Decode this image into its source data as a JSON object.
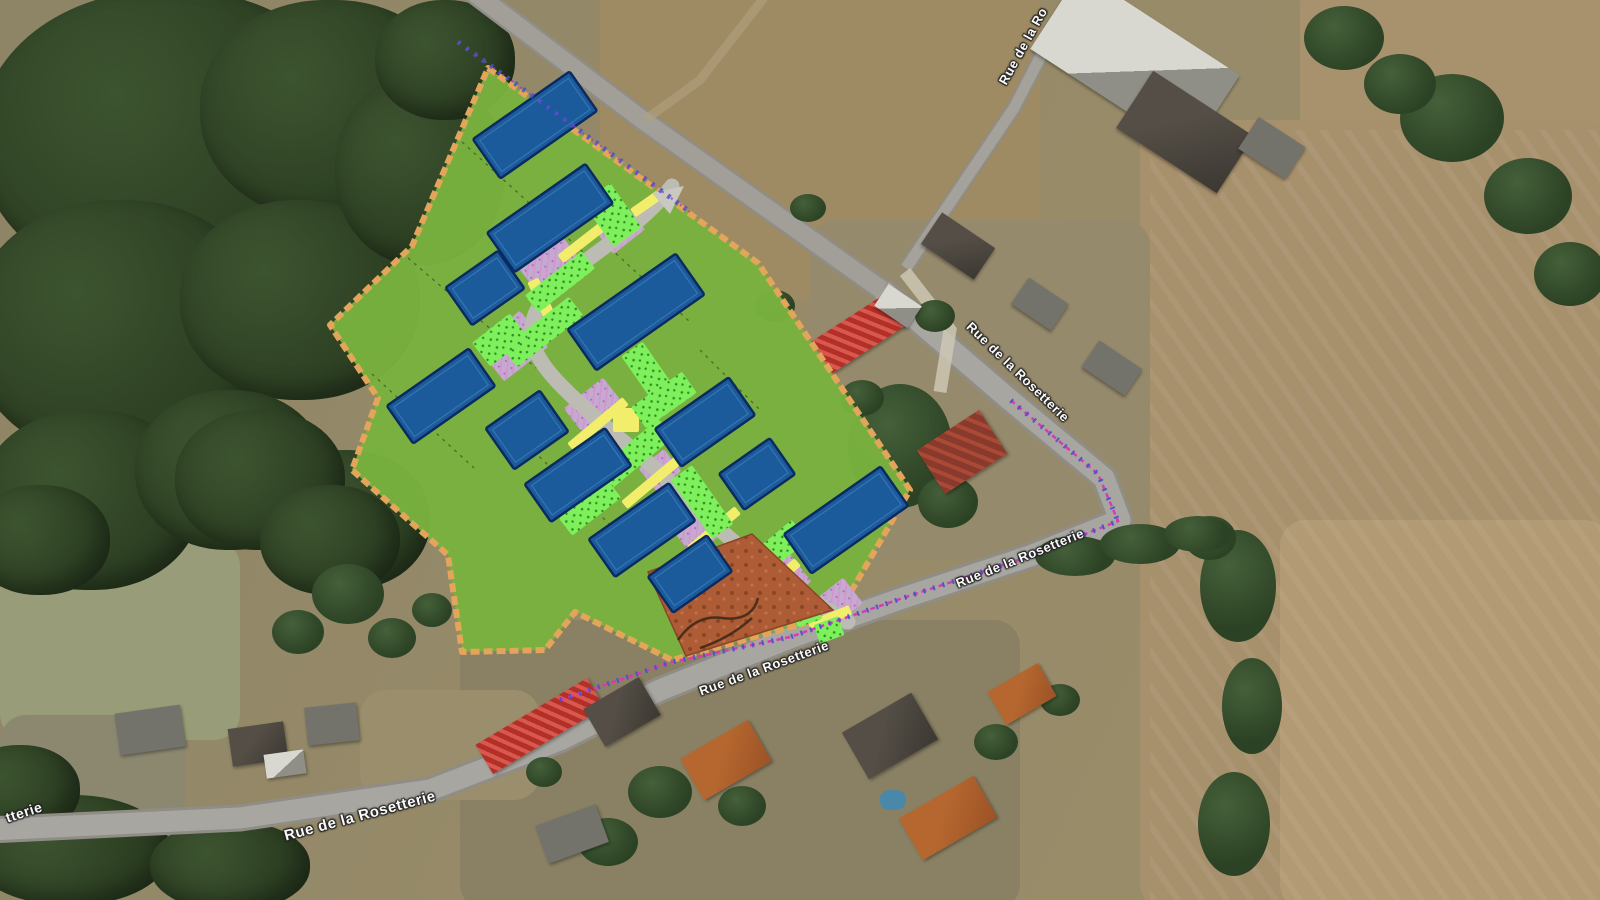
{
  "map": {
    "description_colors": {
      "plan_green": "#79b23f",
      "plan_border_tan": "#e2a55a",
      "building_blue": "#1b5a9b",
      "building_outline": "#0b2b60",
      "hedge_bright_green": "#7df05c",
      "path_yellow": "#f2ee6b",
      "paving_lavender": "#c4aacf",
      "plot_terracotta": "#ad5c36",
      "survey_magenta": "#d83ab2",
      "survey_blue": "#4652c8",
      "road_gray": "#a3a199"
    },
    "street_labels": [
      {
        "id": "rue-top-right-partial",
        "text": "Rue de la Ro",
        "x": 1023,
        "y": 46,
        "rot": -61,
        "size": 13
      },
      {
        "id": "rue-mid-right",
        "text": "Rue de la Rosetterie",
        "x": 1018,
        "y": 372,
        "rot": 44,
        "size": 13
      },
      {
        "id": "rue-east",
        "text": "Rue de la Rosetterie",
        "x": 1020,
        "y": 558,
        "rot": -22,
        "size": 13
      },
      {
        "id": "rue-plan-edge",
        "text": "Rue de la Rosetterie",
        "x": 764,
        "y": 668,
        "rot": -20,
        "size": 13
      },
      {
        "id": "rue-west",
        "text": "Rue de la Rosetterie",
        "x": 360,
        "y": 816,
        "rot": -15,
        "size": 15
      },
      {
        "id": "rue-left-fragment",
        "text": "tterie",
        "x": 24,
        "y": 812,
        "rot": -18,
        "size": 14
      }
    ],
    "site_plan": {
      "fill": "#79b23f",
      "border": "#e2a55a",
      "building_fill": "#1b5a9b",
      "building_stroke": "#0b2b60",
      "road_color": "#bdbcb4",
      "path_color": "#f2ee6b",
      "plot_fill": "#ad5c36",
      "survey_magenta": "#d83ab2",
      "survey_blue": "#4652c8",
      "boundary": [
        [
          488,
          68
        ],
        [
          758,
          263
        ],
        [
          910,
          490
        ],
        [
          838,
          614
        ],
        [
          672,
          660
        ],
        [
          575,
          612
        ],
        [
          545,
          650
        ],
        [
          462,
          652
        ],
        [
          448,
          555
        ],
        [
          352,
          470
        ],
        [
          378,
          398
        ],
        [
          330,
          325
        ],
        [
          412,
          246
        ]
      ],
      "buildings": [
        [
          535,
          125,
          118,
          48
        ],
        [
          550,
          218,
          120,
          48
        ],
        [
          485,
          288,
          64,
          46
        ],
        [
          636,
          312,
          132,
          50
        ],
        [
          441,
          396,
          100,
          46
        ],
        [
          527,
          430,
          66,
          50
        ],
        [
          705,
          422,
          90,
          46
        ],
        [
          578,
          475,
          98,
          46
        ],
        [
          757,
          474,
          62,
          44
        ],
        [
          642,
          530,
          98,
          46
        ],
        [
          846,
          520,
          118,
          48
        ],
        [
          690,
          574,
          72,
          44
        ]
      ],
      "building_rot": -35,
      "road_path": "M672,186 C630,240 560,268 538,308 C520,342 542,368 576,400 C612,434 646,458 684,496 C722,534 762,566 802,594 L848,622",
      "hedges": [
        [
          612,
          215,
          34,
          54,
          -35
        ],
        [
          560,
          282,
          72,
          22,
          -38
        ],
        [
          543,
          332,
          84,
          24,
          -38
        ],
        [
          500,
          340,
          48,
          30,
          -38
        ],
        [
          648,
          372,
          26,
          56,
          -35
        ],
        [
          664,
          400,
          62,
          26,
          -35
        ],
        [
          630,
          458,
          94,
          24,
          -40
        ],
        [
          702,
          502,
          26,
          72,
          -35
        ],
        [
          764,
          560,
          94,
          26,
          -40
        ],
        [
          590,
          508,
          62,
          22,
          -38
        ],
        [
          806,
          612,
          26,
          24,
          -20
        ],
        [
          829,
          630,
          26,
          20,
          -20
        ]
      ],
      "yellow_paths": [
        [
          585,
          240,
          62,
          10,
          -38
        ],
        [
          542,
          300,
          12,
          44,
          -25
        ],
        [
          598,
          424,
          72,
          10,
          -40
        ],
        [
          652,
          482,
          72,
          10,
          -40
        ],
        [
          626,
          420,
          26,
          24,
          0
        ],
        [
          714,
          530,
          62,
          10,
          -40
        ],
        [
          774,
          582,
          62,
          10,
          -40
        ],
        [
          646,
          204,
          32,
          10,
          -35
        ],
        [
          830,
          618,
          44,
          10,
          -22
        ]
      ],
      "paving": [
        [
          548,
          262,
          54,
          40,
          -38
        ],
        [
          512,
          346,
          56,
          46,
          -38
        ],
        [
          595,
          408,
          50,
          38,
          -38
        ],
        [
          700,
          528,
          46,
          36,
          -38
        ],
        [
          780,
          582,
          50,
          38,
          -38
        ],
        [
          838,
          602,
          38,
          32,
          -38
        ],
        [
          660,
          470,
          32,
          28,
          -38
        ],
        [
          620,
          230,
          40,
          30,
          -38
        ]
      ],
      "plot_polygon": [
        [
          648,
          572
        ],
        [
          752,
          534
        ],
        [
          833,
          610
        ],
        [
          686,
          656
        ]
      ],
      "plot_marks": "M678,640 q18,-26 44,-22 q30,4 36,-20 M700,648 q30,-10 52,-30",
      "division_lines": [
        "M462,142 L583,252",
        "M408,258 L536,368",
        "M372,374 L474,468",
        "M610,248 L690,322",
        "M522,440 L628,542",
        "M700,350 L760,410"
      ],
      "survey_paths": {
        "street": "M560,700 L672,662 L790,637 L900,599 L1030,556 L1118,521 L1098,474 L1008,398",
        "top_road": "M458,42 L560,116 L690,212"
      },
      "entrance_island": "652,193 684,186 670,214"
    }
  }
}
